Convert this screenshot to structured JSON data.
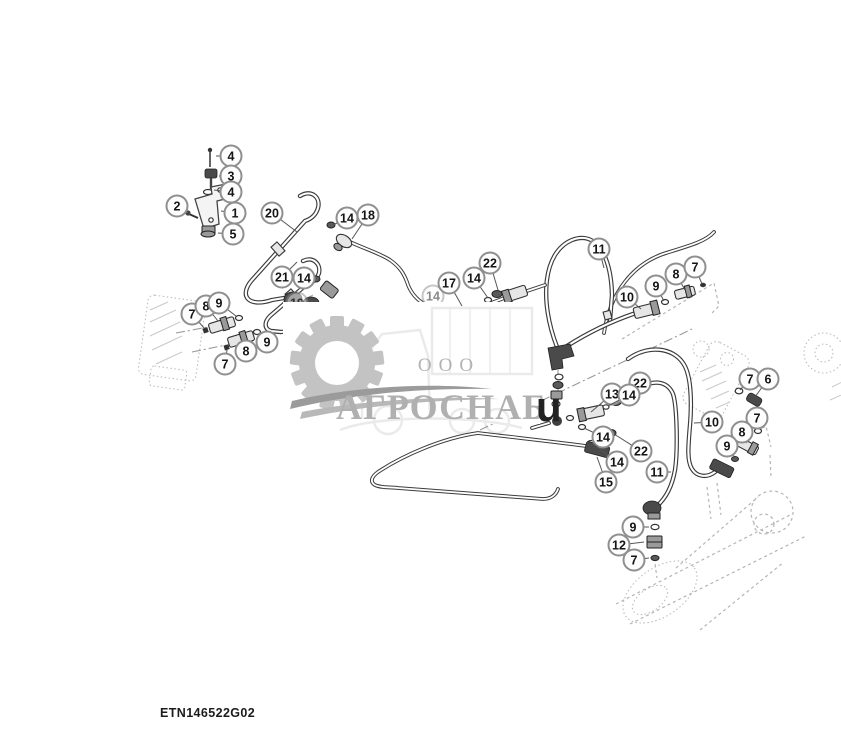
{
  "document": {
    "type": "hydraulic-lines-parts-diagram",
    "drawing_number": "ETN146522G02"
  },
  "watermark": {
    "org_type": "ООО",
    "name": "АГРОСНАБ",
    "mark": "u",
    "gray": "#b0b0b0"
  },
  "colors": {
    "line": "#3c3c3c",
    "ghost": "#b5b5b5",
    "callout_stroke": "#8f8f8f",
    "callout_text": "#141414",
    "background": "#ffffff"
  },
  "callouts": [
    {
      "n": "4",
      "x": 231,
      "y": 156,
      "lx": 216,
      "ly": 156
    },
    {
      "n": "3",
      "x": 231,
      "y": 176,
      "lx": 219,
      "ly": 176
    },
    {
      "n": "4",
      "x": 231,
      "y": 192,
      "lx": 214,
      "ly": 190
    },
    {
      "n": "2",
      "x": 177,
      "y": 206,
      "lx": 188,
      "ly": 213
    },
    {
      "n": "1",
      "x": 235,
      "y": 213,
      "lx": 221,
      "ly": 211
    },
    {
      "n": "5",
      "x": 233,
      "y": 234,
      "lx": 218,
      "ly": 233
    },
    {
      "n": "20",
      "x": 272,
      "y": 213,
      "lx": 297,
      "ly": 232
    },
    {
      "n": "21",
      "x": 282,
      "y": 277,
      "lx": 297,
      "ly": 262
    },
    {
      "n": "14",
      "x": 347,
      "y": 218,
      "lx": 333,
      "ly": 225
    },
    {
      "n": "18",
      "x": 368,
      "y": 215,
      "lx": 352,
      "ly": 239
    },
    {
      "n": "14",
      "x": 304,
      "y": 278,
      "lx": 316,
      "ly": 280
    },
    {
      "n": "7",
      "x": 192,
      "y": 314,
      "lx": 204,
      "ly": 328
    },
    {
      "n": "8",
      "x": 206,
      "y": 306,
      "lx": 218,
      "ly": 321
    },
    {
      "n": "9",
      "x": 219,
      "y": 303,
      "lx": 236,
      "ly": 316
    },
    {
      "n": "9",
      "x": 267,
      "y": 342,
      "lx": 259,
      "ly": 333
    },
    {
      "n": "8",
      "x": 246,
      "y": 351,
      "lx": 243,
      "ly": 342
    },
    {
      "n": "7",
      "x": 225,
      "y": 364,
      "lx": 227,
      "ly": 350
    },
    {
      "n": "19",
      "x": 297,
      "y": 303,
      "lx": 313,
      "ly": 295,
      "layer": "under"
    },
    {
      "n": "14",
      "x": 433,
      "y": 296,
      "lx": 447,
      "ly": 308,
      "layer": "under"
    },
    {
      "n": "17",
      "x": 449,
      "y": 283,
      "lx": 462,
      "ly": 306
    },
    {
      "n": "14",
      "x": 474,
      "y": 278,
      "lx": 488,
      "ly": 298
    },
    {
      "n": "22",
      "x": 490,
      "y": 263,
      "lx": 498,
      "ly": 290
    },
    {
      "n": "11",
      "x": 599,
      "y": 249,
      "lx": 604,
      "ly": 268
    },
    {
      "n": "10",
      "x": 627,
      "y": 297,
      "lx": 641,
      "ly": 309
    },
    {
      "n": "9",
      "x": 656,
      "y": 286,
      "lx": 664,
      "ly": 301
    },
    {
      "n": "8",
      "x": 676,
      "y": 274,
      "lx": 685,
      "ly": 290
    },
    {
      "n": "7",
      "x": 695,
      "y": 267,
      "lx": 702,
      "ly": 284
    },
    {
      "n": "22",
      "x": 640,
      "y": 383,
      "lx": 620,
      "ly": 400
    },
    {
      "n": "13",
      "x": 612,
      "y": 394,
      "lx": 591,
      "ly": 412
    },
    {
      "n": "14",
      "x": 629,
      "y": 395,
      "lx": 608,
      "ly": 406
    },
    {
      "n": "14",
      "x": 603,
      "y": 437,
      "lx": 584,
      "ly": 428
    },
    {
      "n": "22",
      "x": 641,
      "y": 451,
      "lx": 614,
      "ly": 434
    },
    {
      "n": "14",
      "x": 617,
      "y": 462,
      "lx": 592,
      "ly": 443
    },
    {
      "n": "15",
      "x": 606,
      "y": 482,
      "lx": 597,
      "ly": 457
    },
    {
      "n": "11",
      "x": 657,
      "y": 472,
      "lx": 671,
      "ly": 472
    },
    {
      "n": "10",
      "x": 712,
      "y": 422,
      "lx": 694,
      "ly": 423
    },
    {
      "n": "7",
      "x": 750,
      "y": 379,
      "lx": 740,
      "ly": 390
    },
    {
      "n": "6",
      "x": 768,
      "y": 379,
      "lx": 755,
      "ly": 397
    },
    {
      "n": "7",
      "x": 757,
      "y": 418,
      "lx": 757,
      "ly": 429
    },
    {
      "n": "8",
      "x": 742,
      "y": 432,
      "lx": 747,
      "ly": 443
    },
    {
      "n": "9",
      "x": 727,
      "y": 446,
      "lx": 734,
      "ly": 456
    },
    {
      "n": "9",
      "x": 633,
      "y": 527,
      "lx": 649,
      "ly": 527
    },
    {
      "n": "12",
      "x": 619,
      "y": 545,
      "lx": 644,
      "ly": 542
    },
    {
      "n": "7",
      "x": 634,
      "y": 560,
      "lx": 649,
      "ly": 558
    }
  ]
}
